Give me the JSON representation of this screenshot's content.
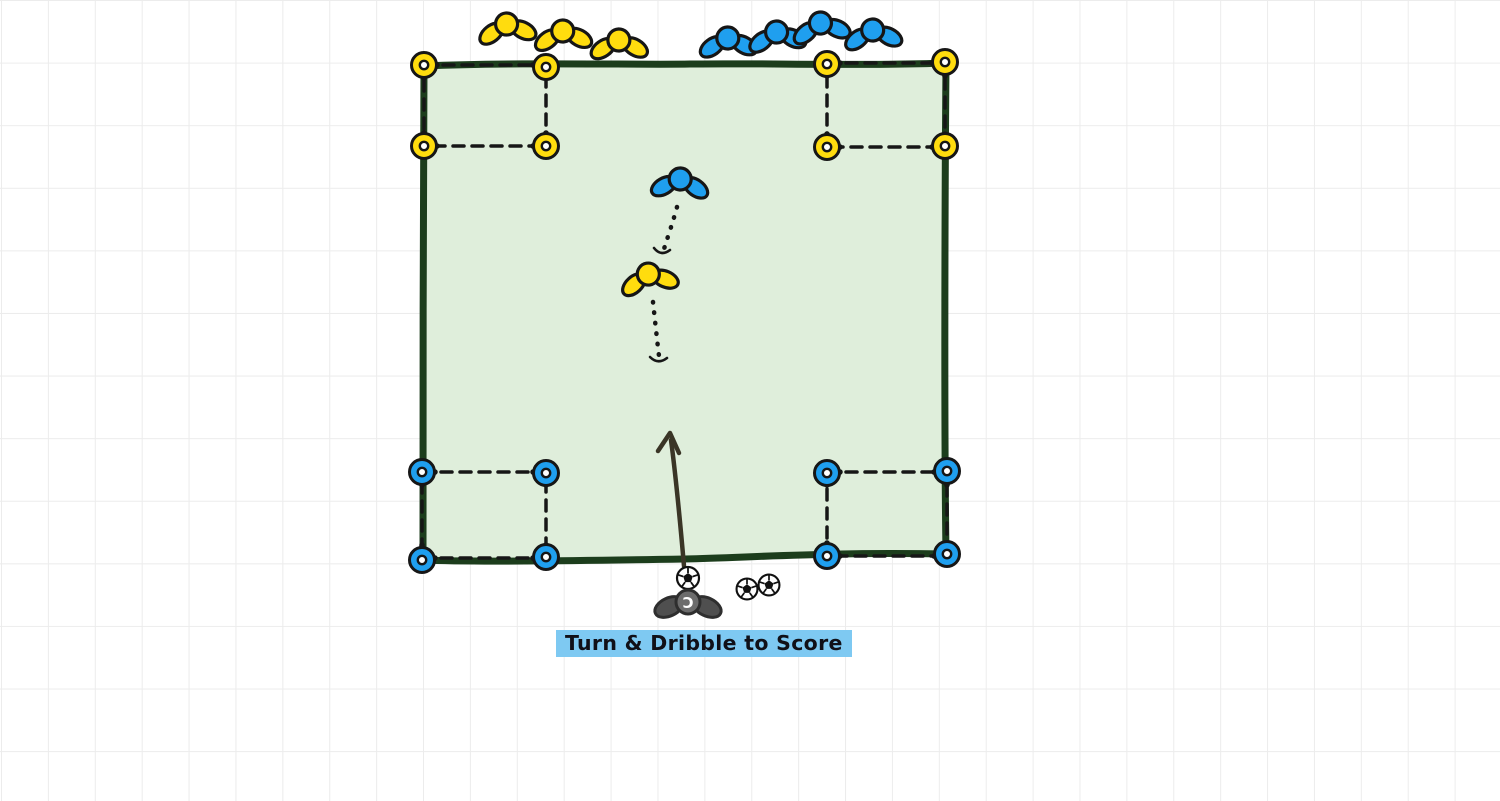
{
  "colors": {
    "canvas-bg": "#FFFFFF",
    "grid": "#ECECEC",
    "team-yellow": "#FFDC0E",
    "team-blue": "#1F9FEF",
    "field-fill": "#DFEEDB",
    "field-border": "#1C3D1C",
    "ink": "#161616",
    "coach-body": "#4F4F4F",
    "coach-head": "#6C6C6C",
    "arrow": "#3A3526",
    "label-highlight": "#7EC9F2",
    "label-text": "#101018"
  },
  "diagram": {
    "label": "Turn & Dribble to Score",
    "coach_initial": "C",
    "teams": {
      "yellow": {
        "waiting_players": 3,
        "field_players": 1,
        "corner_markers": 8
      },
      "blue": {
        "waiting_players": 4,
        "field_players": 1,
        "corner_markers": 8
      }
    },
    "corner_goal_zones": 4,
    "balls": 3
  }
}
